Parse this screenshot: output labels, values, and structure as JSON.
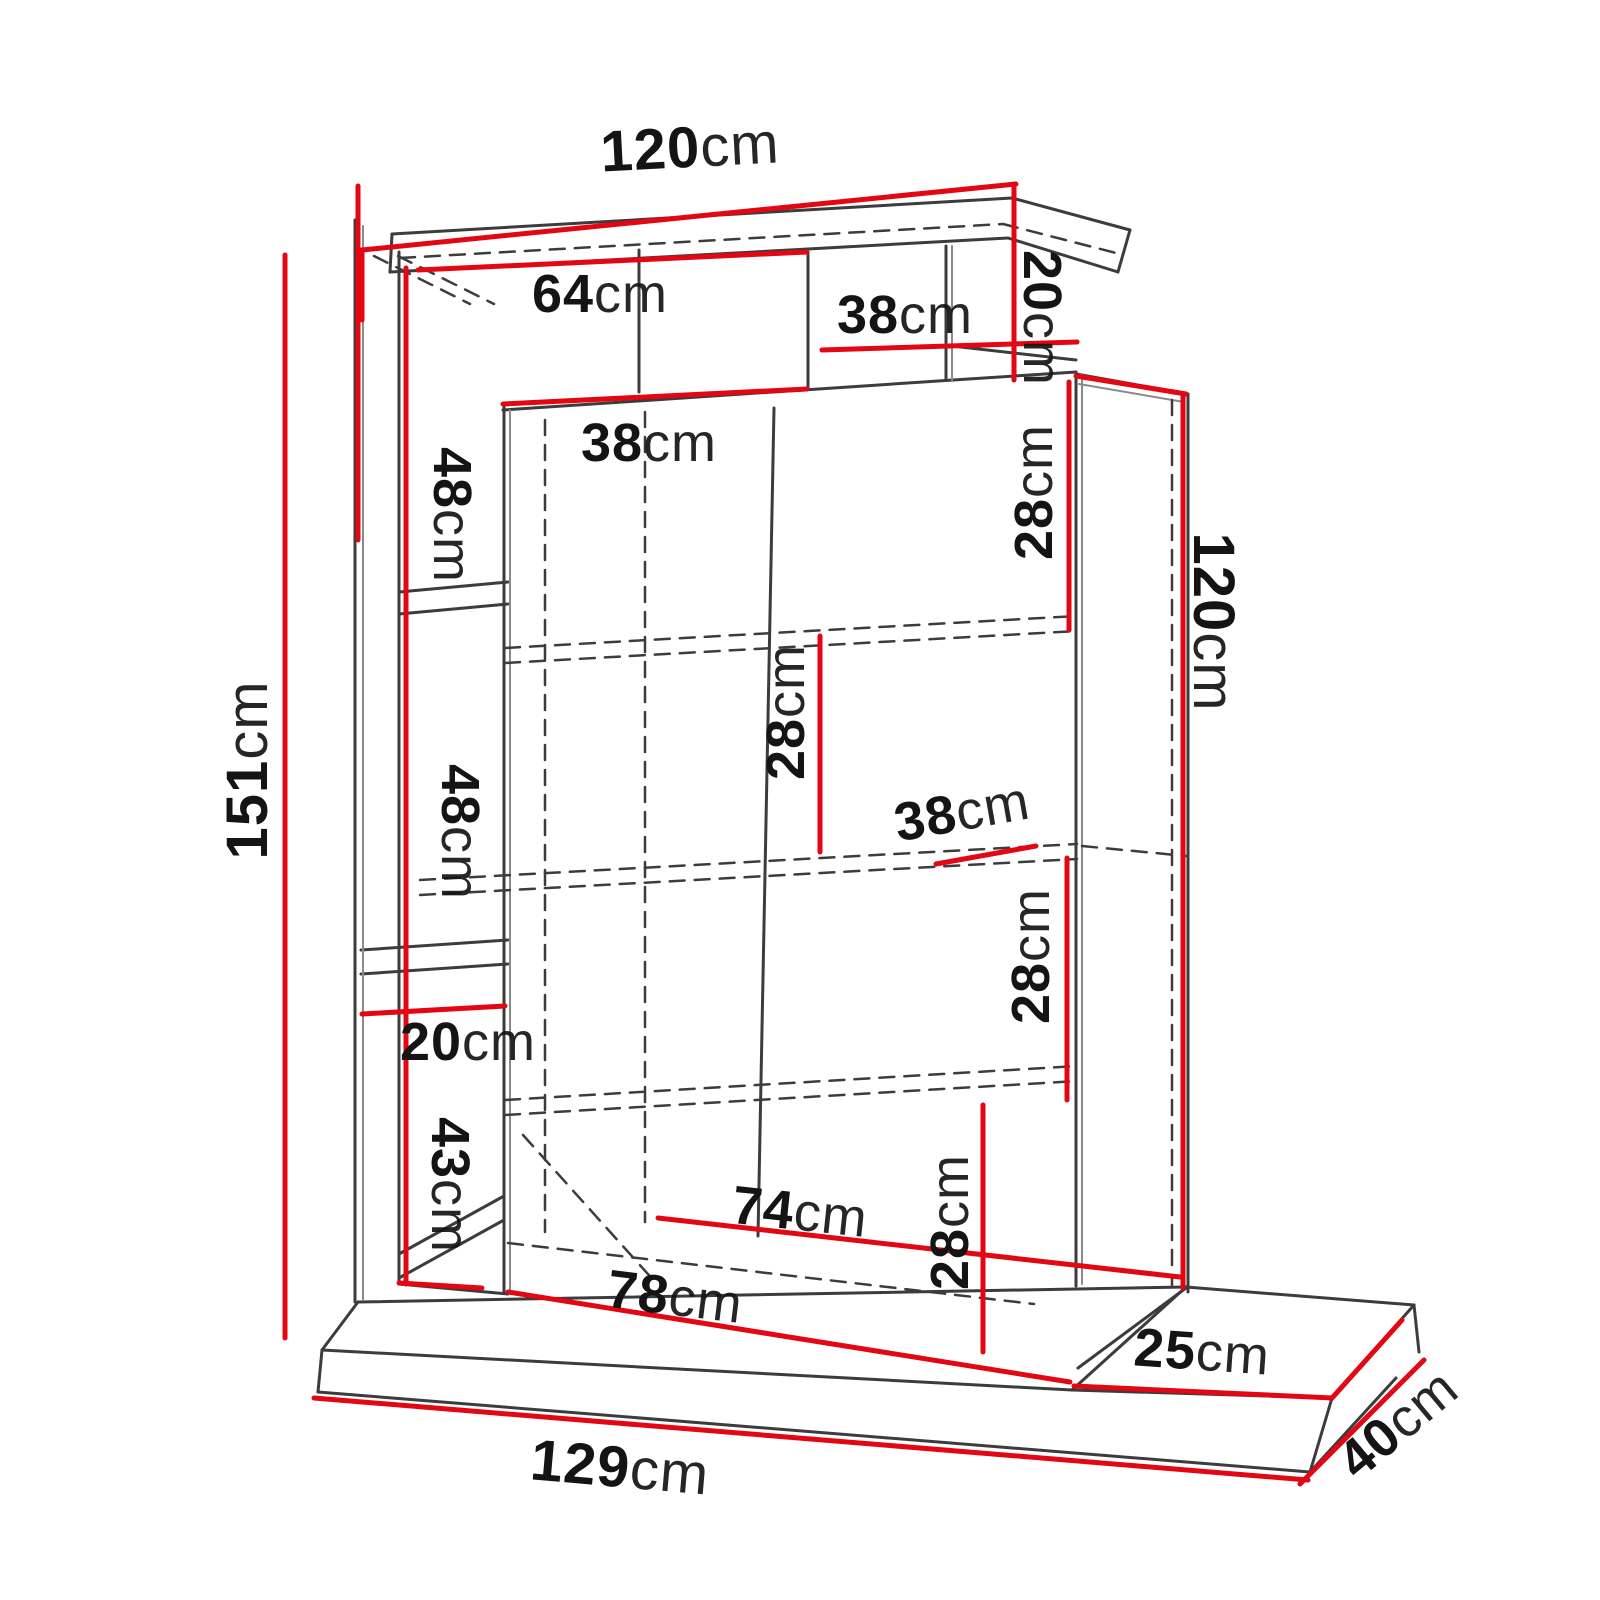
{
  "diagram": {
    "type": "furniture-dimension-drawing",
    "unit": "cm",
    "colors": {
      "dimension_line": "#e30613",
      "drawing_line": "#3c3c3c",
      "background": "#ffffff",
      "text": "#141414"
    }
  },
  "dims": {
    "top_width": {
      "value": "120",
      "unit": "cm"
    },
    "niche_left_width": {
      "value": "64",
      "unit": "cm"
    },
    "niche_top_width": {
      "value": "38",
      "unit": "cm"
    },
    "top_right_height": {
      "value": "20",
      "unit": "cm"
    },
    "cabinet_top_depth": {
      "value": "38",
      "unit": "cm"
    },
    "left_col_top": {
      "value": "48",
      "unit": "cm"
    },
    "right_shelf_top": {
      "value": "28",
      "unit": "cm"
    },
    "right_height": {
      "value": "120",
      "unit": "cm"
    },
    "total_height": {
      "value": "151",
      "unit": "cm"
    },
    "mid_shelf": {
      "value": "28",
      "unit": "cm"
    },
    "left_col_mid": {
      "value": "48",
      "unit": "cm"
    },
    "shelf_depth": {
      "value": "38",
      "unit": "cm"
    },
    "right_shelf_low": {
      "value": "28",
      "unit": "cm"
    },
    "left_col_gap": {
      "value": "20",
      "unit": "cm"
    },
    "left_col_bottom": {
      "value": "43",
      "unit": "cm"
    },
    "bottom_inner_width": {
      "value": "74",
      "unit": "cm"
    },
    "bottom_height": {
      "value": "28",
      "unit": "cm"
    },
    "bottom_width": {
      "value": "78",
      "unit": "cm"
    },
    "base_right_depth": {
      "value": "25",
      "unit": "cm"
    },
    "base_width": {
      "value": "129",
      "unit": "cm"
    },
    "base_depth": {
      "value": "40",
      "unit": "cm"
    }
  }
}
